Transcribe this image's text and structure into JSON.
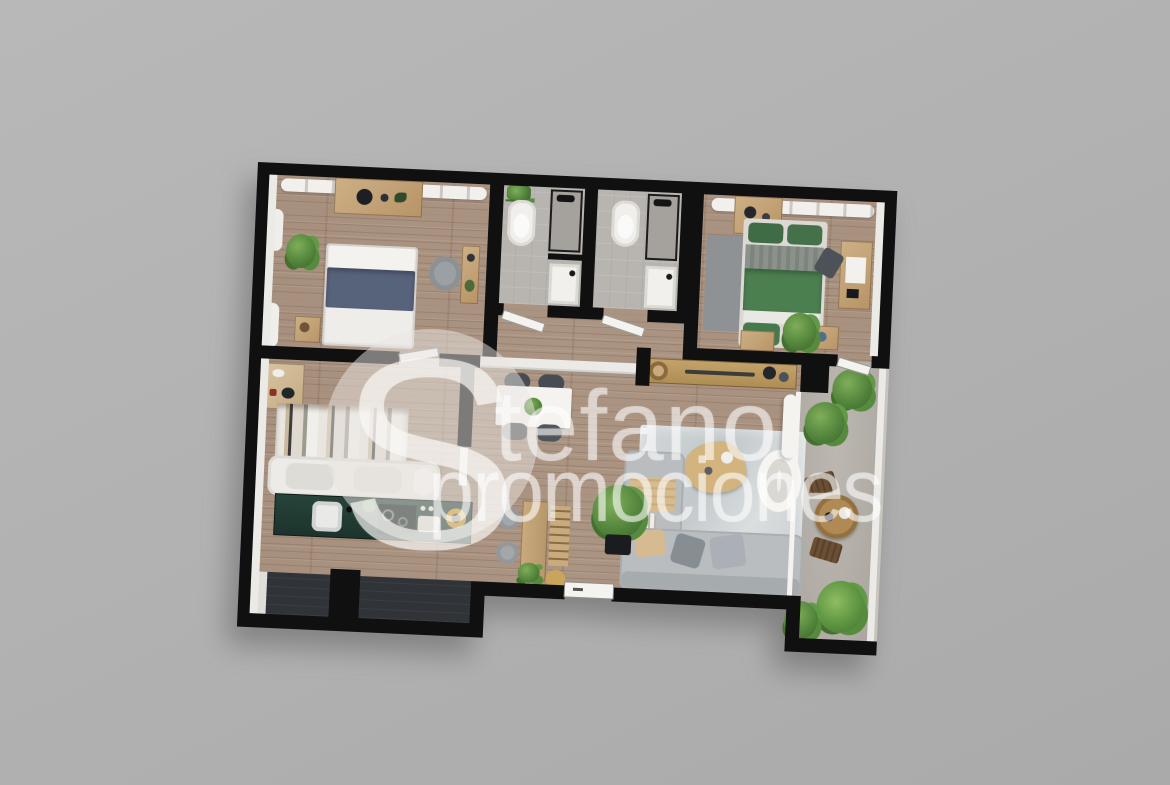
{
  "watermark": {
    "initial": "S",
    "name_rest": "tefano",
    "line2": "promociones",
    "full_text": "Stefano promociones"
  },
  "scene": {
    "description": "Top-down 3D architectural render of a two-bedroom apartment floor plan with two bathrooms, open living-dining-kitchen area, dressing room, entry hall and side terrace, on a plain gray backdrop with a large translucent watermark",
    "background_color": "#b1b1b1",
    "wall_color": "#101010",
    "wood_floor_color": "#a8917f",
    "tile_floor_color": "#b8b4b0",
    "terrace_floor_color": "#b2aea7",
    "entry_hall_floor_color": "#303338",
    "kitchen_counter_color": "#21362f",
    "bed_green_color": "#4b7f50",
    "bed_navy_color": "#57627b",
    "sofa_color": "#b9bdc0",
    "wood_furniture_color": "#c2a377",
    "plant_color": "#53853c",
    "watermark_color": "rgba(255,255,255,0.52)"
  },
  "rooms": [
    {
      "id": "bedroom-left",
      "furniture": [
        "wardrobe",
        "radiator",
        "double-bed-navy",
        "nightstand",
        "plant",
        "armchair",
        "wall-console",
        "curtains"
      ]
    },
    {
      "id": "bathroom-1",
      "furniture": [
        "plant-shelf",
        "toilet",
        "shower",
        "washbasin",
        "door"
      ]
    },
    {
      "id": "bathroom-2",
      "furniture": [
        "toilet",
        "shower",
        "washbasin",
        "door"
      ]
    },
    {
      "id": "bedroom-right",
      "furniture": [
        "wardrobe",
        "radiator",
        "double-bed-green",
        "rug",
        "desk",
        "chair",
        "nightstand",
        "bench",
        "plant",
        "door"
      ]
    },
    {
      "id": "dressing-room",
      "furniture": [
        "vanity-shelf",
        "open-wardrobe",
        "white-sofa",
        "door"
      ]
    },
    {
      "id": "kitchen",
      "furniture": [
        "counter",
        "sink",
        "cooktop",
        "appliance",
        "bowl"
      ]
    },
    {
      "id": "dining-area",
      "furniture": [
        "dining-table",
        "four-chairs",
        "plant-centerpiece"
      ]
    },
    {
      "id": "study-nook",
      "furniture": [
        "bar-table",
        "two-stools",
        "ladder-shelf",
        "pouf",
        "potted-plant"
      ]
    },
    {
      "id": "living-room",
      "furniture": [
        "sideboard",
        "rug",
        "coffee-table",
        "round-armchair",
        "corner-sofa",
        "cushions",
        "floor-plant",
        "curtain"
      ]
    },
    {
      "id": "entry-hall",
      "furniture": [
        "front-door",
        "closet-block"
      ]
    },
    {
      "id": "terrace",
      "furniture": [
        "bistro-table",
        "two-chairs",
        "plants",
        "railing",
        "glass-wall"
      ]
    }
  ]
}
